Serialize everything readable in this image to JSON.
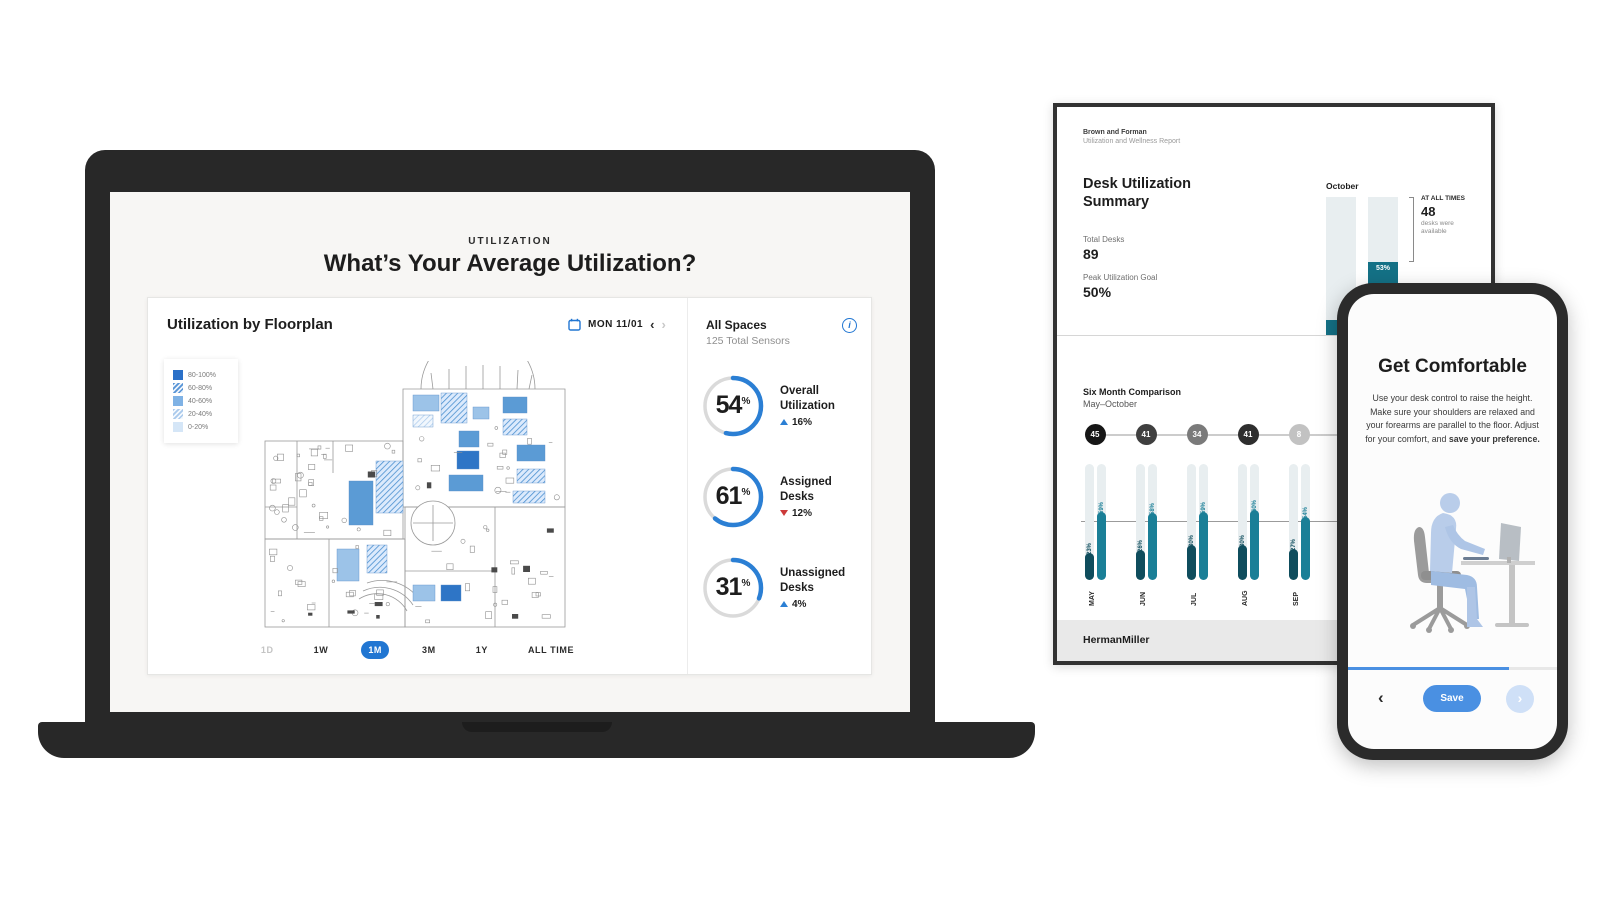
{
  "accent_blue": "#2b7fd4",
  "teal": "#1a7f97",
  "dark_teal": "#0f4d5d",
  "laptop": {
    "eyebrow": "UTILIZATION",
    "title": "What’s Your Average Utilization?",
    "card": {
      "title": "Utilization by Floorplan",
      "date_label": "MON 11/01",
      "prev_icon": "‹",
      "next_icon": "›",
      "legend": [
        {
          "label": "80-100%",
          "style": "solid-1"
        },
        {
          "label": "60-80%",
          "style": "hatch-1"
        },
        {
          "label": "40-60%",
          "style": "solid-2"
        },
        {
          "label": "20-40%",
          "style": "hatch-2"
        },
        {
          "label": "0-20%",
          "style": "solid-3"
        }
      ],
      "time_ranges": [
        {
          "label": "1D",
          "state": "disabled"
        },
        {
          "label": "1W",
          "state": "normal"
        },
        {
          "label": "1M",
          "state": "selected"
        },
        {
          "label": "3M",
          "state": "normal"
        },
        {
          "label": "1Y",
          "state": "normal"
        },
        {
          "label": "ALL TIME",
          "state": "normal"
        }
      ],
      "panel": {
        "title": "All Spaces",
        "subtitle": "125 Total Sensors",
        "info_icon": "i",
        "stats": [
          {
            "value": 54,
            "unit": "%",
            "label_lines": [
              "Overall",
              "Utilization"
            ],
            "change": "16%",
            "direction": "up"
          },
          {
            "value": 61,
            "unit": "%",
            "label_lines": [
              "Assigned",
              "Desks"
            ],
            "change": "12%",
            "direction": "down"
          },
          {
            "value": 31,
            "unit": "%",
            "label_lines": [
              "Unassigned",
              "Desks"
            ],
            "change": "4%",
            "direction": "up"
          }
        ]
      }
    }
  },
  "report": {
    "company": "Brown and Forman",
    "report_name": "Utilization and Wellness Report",
    "summary_title": "Desk Utilization Summary",
    "metrics": [
      {
        "label": "Total Desks",
        "value": "89"
      },
      {
        "label": "Peak Utilization Goal",
        "value": "50%"
      }
    ],
    "october": {
      "title": "October",
      "columns": [
        {
          "fill_pct": 11,
          "label": ""
        },
        {
          "fill_pct": 53,
          "label": "53%"
        }
      ],
      "callout": {
        "eyebrow": "AT ALL TIMES",
        "value": "48",
        "caption": "desks were available"
      }
    },
    "six_month": {
      "title": "Six Month Comparison",
      "subtitle": "May–October",
      "goal_line_pct": 50,
      "months": [
        {
          "name": "MAY",
          "count": "45",
          "count_shade": "#161616",
          "bars": [
            {
              "pct": 23,
              "label": "23%",
              "type": "dark"
            },
            {
              "pct": 59,
              "label": "59%",
              "type": "teal"
            }
          ]
        },
        {
          "name": "JUN",
          "count": "41",
          "count_shade": "#3f3f3f",
          "bars": [
            {
              "pct": 26,
              "label": "26%",
              "type": "dark"
            },
            {
              "pct": 58,
              "label": "58%",
              "type": "teal"
            }
          ]
        },
        {
          "name": "JUL",
          "count": "34",
          "count_shade": "#7a7a7a",
          "bars": [
            {
              "pct": 30,
              "label": "30%",
              "type": "dark"
            },
            {
              "pct": 59,
              "label": "59%",
              "type": "teal"
            }
          ]
        },
        {
          "name": "AUG",
          "count": "41",
          "count_shade": "#2e2e2e",
          "bars": [
            {
              "pct": 30,
              "label": "30%",
              "type": "dark"
            },
            {
              "pct": 60,
              "label": "60%",
              "type": "teal"
            }
          ]
        },
        {
          "name": "SEP",
          "count": "8",
          "count_shade": "#c2c2c2",
          "bars": [
            {
              "pct": 27,
              "label": "27%",
              "type": "dark"
            },
            {
              "pct": 54,
              "label": "54%",
              "type": "teal"
            }
          ]
        }
      ]
    },
    "footer_logo": "HermanMiller"
  },
  "phone": {
    "title": "Get Comfortable",
    "body": "Use your desk control to raise the height. Make sure your shoulders are relaxed and your forearms are parallel to the floor. Adjust for your comfort, and ",
    "body_bold": "save your preference.",
    "back_icon": "‹",
    "save_label": "Save",
    "next_icon": "›",
    "progress_pct": 77
  }
}
